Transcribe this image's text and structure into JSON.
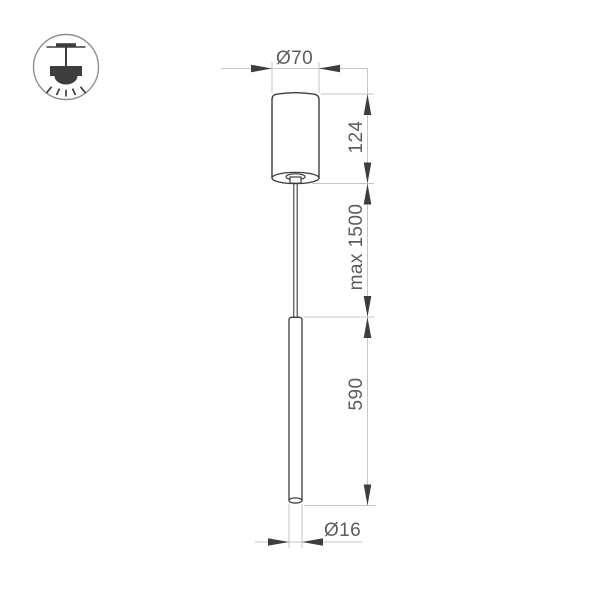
{
  "page": {
    "background": "#ffffff",
    "kind": "product dimension drawing"
  },
  "icon": {
    "name": "ceiling-pendant-light",
    "stroke_color": "#8f8f8f",
    "glyph_color": "#3d3d3d"
  },
  "drawing": {
    "outline_color": "#3d3d3d",
    "dim_line_color": "#c6c6c6",
    "dim_text_color": "#5c5c5c",
    "labels": {
      "top_diameter": "Ø70",
      "canopy_height": "124",
      "suspension_length": "max 1500",
      "tube_length": "590",
      "tube_diameter": "Ø16"
    }
  }
}
